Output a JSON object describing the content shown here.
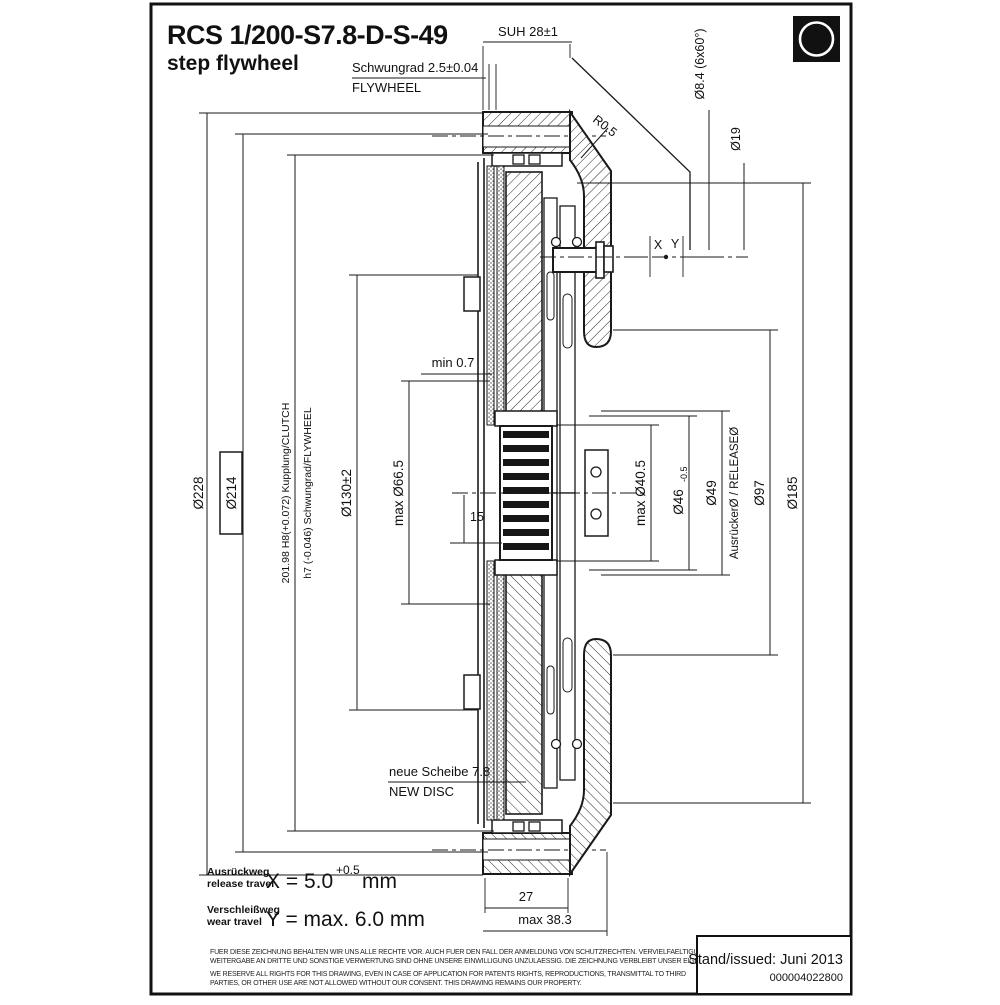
{
  "meta": {
    "code": "RCS 1/200-S7.8-D-S-49",
    "type": "step flywheel",
    "brand": "ZF",
    "issued": "Stand/issued: Juni 2013",
    "doc": "000004022800"
  },
  "legal": {
    "de1": "FUER DIESE ZEICHNUNG BEHALTEN WIR UNS ALLE RECHTE VOR. AUCH FUER DEN FALL DER ANMELDUNG VON SCHUTZRECHTEN. VERVIELFAELTIGUNG,",
    "de2": "WEITERGABE AN DRITTE UND SONSTIGE VERWERTUNG SIND OHNE UNSERE EINWILLIGUNG UNZULAESSIG. DIE ZEICHNUNG VERBLEIBT UNSER EIGENTUM.",
    "en1": "WE RESERVE ALL RIGHTS FOR THIS DRAWING, EVEN IN CASE OF APPLICATION FOR PATENTS RIGHTS, REPRODUCTIONS, TRANSMITTAL TO THIRD",
    "en2": "PARTIES, OR OTHER USE ARE NOT ALLOWED WITHOUT OUR CONSENT. THIS DRAWING REMAINS OUR PROPERTY."
  },
  "travel": {
    "release_de": "Ausrückweg",
    "release_en": "release travel",
    "release_val": "X = 5.0",
    "release_tol": "+0.5",
    "release_unit": "mm",
    "wear_de": "Verschleißweg",
    "wear_en": "wear travel",
    "wear_val": "Y = max. 6.0 mm"
  },
  "dims": {
    "suh": "SUH 28±1",
    "schwungrad": "Schwungrad 2.5±0.04",
    "flywheel": "FLYWHEEL",
    "bolt_circle": "Ø8.4 (6x60°)",
    "d19": "Ø19",
    "r05": "R0.5",
    "x": "X",
    "y": "Y",
    "min07": "min 0.7",
    "d228": "Ø228",
    "d214": "Ø214",
    "fit_clutch": "201.98 H8(+0.072) Kupplung/CLUTCH",
    "fit_flywheel": "h7 (-0.046) Schwungrad/FLYWHEEL",
    "d130": "Ø130±2",
    "d665": "max Ø66.5",
    "n15": "15",
    "d405": "max Ø40.5",
    "d46": "Ø46",
    "d46_tol": "-0.5",
    "d49": "Ø49",
    "release_dia": "AusrückerØ / RELEASEØ",
    "d97": "Ø97",
    "d185": "Ø185",
    "new_disc_de": "neue Scheibe 7.8",
    "new_disc_en": "NEW DISC",
    "n27": "27",
    "max383": "max 38.3"
  }
}
